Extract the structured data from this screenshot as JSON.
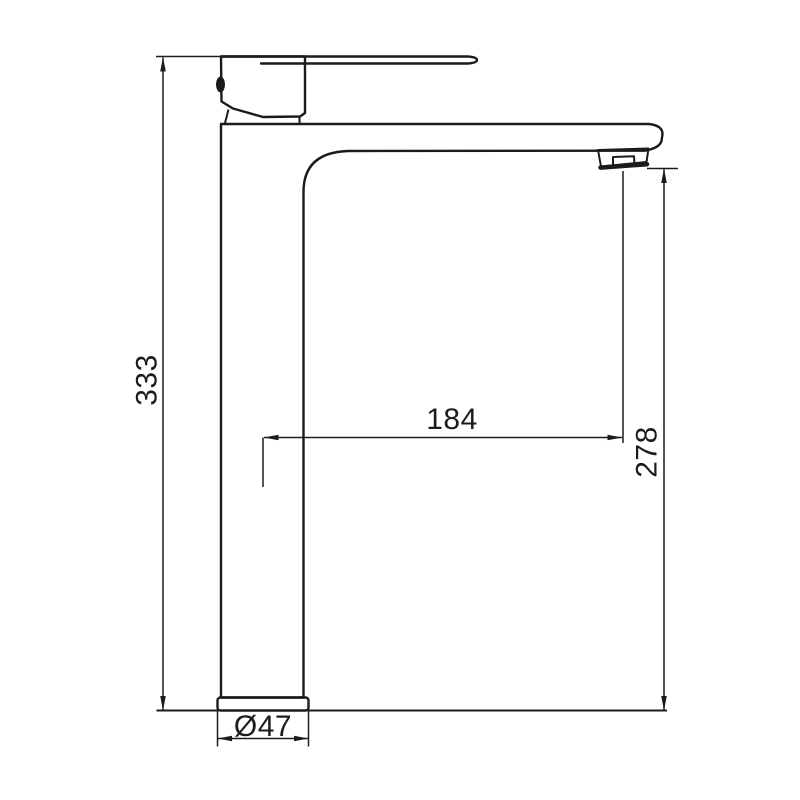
{
  "canvas": {
    "background": "#ffffff",
    "line_color": "#1b1b1b",
    "dimension_line_color": "#1c1c1c"
  },
  "drawing": {
    "subject": "single-lever tall basin mixer tap, side elevation technical drawing",
    "labels": {
      "overall_height": "333",
      "spout_reach": "184",
      "outlet_height": "278",
      "base_diameter": "Ø47"
    }
  }
}
